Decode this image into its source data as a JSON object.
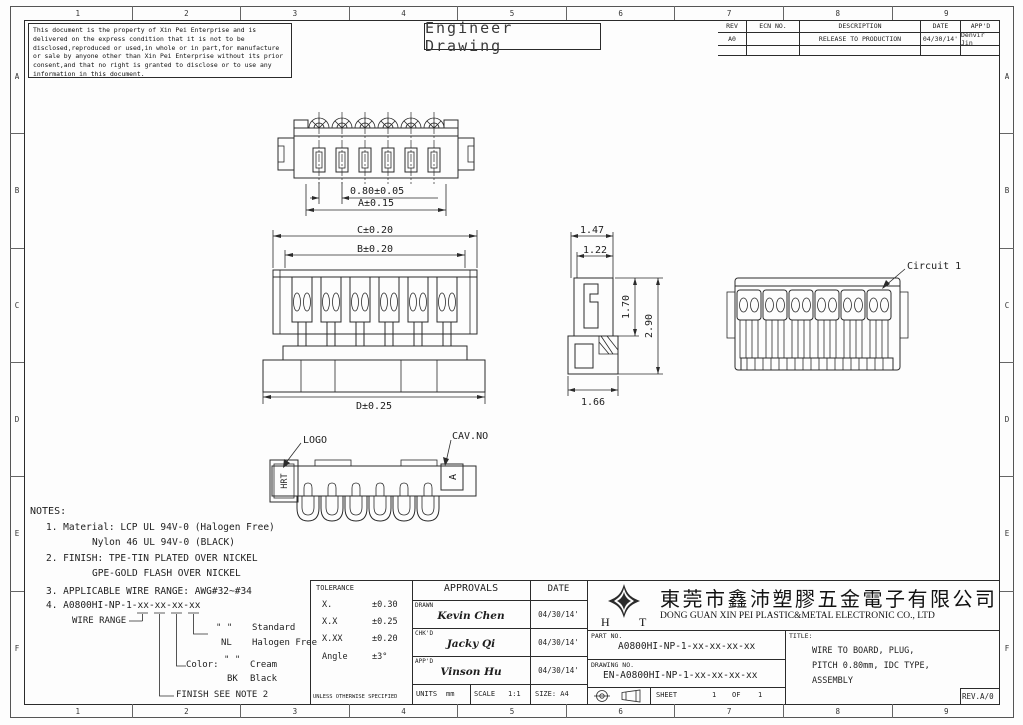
{
  "page": {
    "frame_columns": [
      "1",
      "2",
      "3",
      "4",
      "5",
      "6",
      "7",
      "8",
      "9"
    ],
    "frame_rows": [
      "A",
      "B",
      "C",
      "D",
      "E",
      "F"
    ],
    "title_box": "Engineer Drawing"
  },
  "disclaimer": "This document is the property of Xin Pei Enterprise and is delivered on the express condition that it is not to be disclosed,reproduced or used,in whole or in part,for manufacture or sale by anyone other than Xin Pei Enterprise without its prior consent,and that no right is granted to disclose or to use any information in this document.",
  "revision_table": {
    "col_rev": "REV",
    "col_ecn": "ECN NO.",
    "col_desc": "DESCRIPTION",
    "col_date": "DATE",
    "col_appd": "APP'D",
    "row": {
      "rev": "A0",
      "ecn": "",
      "description": "RELEASE TO PRODUCTION",
      "date": "04/30/14'",
      "appd": "Denvir Jin"
    }
  },
  "views": {
    "top": {
      "dim_pitch": "0.80±0.05",
      "dim_width": "A±0.15"
    },
    "front": {
      "dim_c": "C±0.20",
      "dim_b": "B±0.20",
      "dim_d": "D±0.25"
    },
    "side": {
      "dim_top_outer": "1.47",
      "dim_top_inner": "1.22",
      "dim_height_inner": "1.70",
      "dim_height_outer": "2.90",
      "dim_bottom": "1.66"
    },
    "rear": {
      "circuit_label": "Circuit 1"
    },
    "bottom": {
      "logo_label": "LOGO",
      "cav_label": "CAV.NO",
      "logo_marking": "HRT",
      "cav_marking": "A"
    }
  },
  "notes": {
    "heading": "NOTES:",
    "note1": "1. Material: LCP UL 94V-0 (Halogen Free)",
    "note1b": "Nylon 46 UL 94V-0 (BLACK)",
    "note2": "2. FINISH: TPE-TIN PLATED OVER NICKEL",
    "note2b": "GPE-GOLD FLASH OVER NICKEL",
    "note3": "3. APPLICABLE WIRE RANGE: AWG#32~#34",
    "note4": "4. A0800HI-NP-1-xx-xx-xx-xx",
    "wire_range_label": "WIRE RANGE",
    "std_code": "\" \"",
    "std_value": "Standard",
    "nl_code": "NL",
    "nl_value": "Halogen Free",
    "color_label": "Color:",
    "cream_code": "\" \"",
    "cream_value": "Cream",
    "bk_code": "BK",
    "bk_value": "Black",
    "finish_note": "FINISH SEE NOTE 2"
  },
  "tolerance": {
    "heading": "TOLERANCE",
    "r1_label": "X.",
    "r1_value": "±0.30",
    "r2_label": "X.X",
    "r2_value": "±0.25",
    "r3_label": "X.XX",
    "r3_value": "±0.20",
    "r4_label": "Angle",
    "r4_value": "±3°",
    "footer": "UNLESS OTHERWISE SPECIFIED"
  },
  "approvals": {
    "heading": "APPROVALS",
    "date_heading": "DATE",
    "drawn_label": "DRAWN",
    "drawn_name": "Kevin Chen",
    "drawn_date": "04/30/14'",
    "chkd_label": "CHK'D",
    "chkd_name": "Jacky Qi",
    "chkd_date": "04/30/14'",
    "appd_label": "APP'D",
    "appd_name": "Vinson Hu",
    "appd_date": "04/30/14'",
    "units_label": "UNITS",
    "units_value": "mm",
    "scale_label": "SCALE",
    "scale_value": "1:1",
    "size_label": "SIZE: A4"
  },
  "company": {
    "logo_h": "H",
    "logo_t": "T",
    "name_cn": "東莞市鑫沛塑膠五金電子有限公司",
    "name_en": "DONG GUAN XIN PEI PLASTIC&METAL ELECTRONIC CO., LTD"
  },
  "title_block": {
    "part_label": "PART NO.",
    "part_no": "A0800HI-NP-1-xx-xx-xx-xx",
    "drawing_label": "DRAWING NO.",
    "drawing_no": "EN-A0800HI-NP-1-xx-xx-xx-xx",
    "sheet_label": "SHEET",
    "sheet_num": "1",
    "sheet_of": "OF",
    "sheet_total": "1",
    "title_label": "TITLE:",
    "title_line1": "WIRE TO BOARD, PLUG,",
    "title_line2": "PITCH 0.80mm, IDC TYPE,",
    "title_line3": "ASSEMBLY",
    "rev_label": "REV.A/0"
  }
}
